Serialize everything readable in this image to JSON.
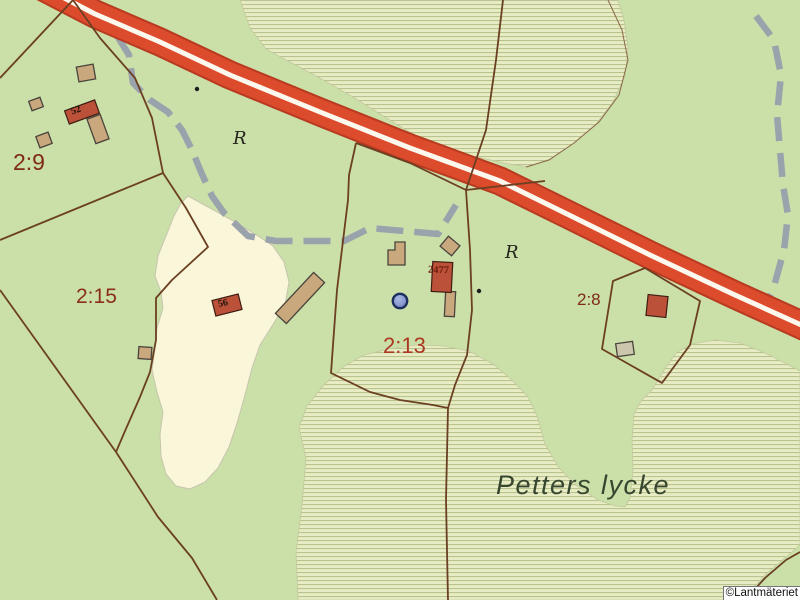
{
  "map": {
    "copyright": "©Lantmäteriet",
    "place_name": "Petters lycke",
    "parcel_labels": [
      {
        "id": "2-9",
        "label": "2:9"
      },
      {
        "id": "2-15",
        "label": "2:15"
      },
      {
        "id": "2-13",
        "label": "2:13"
      },
      {
        "id": "2-8",
        "label": "2:8"
      }
    ],
    "building_labels": [
      {
        "id": "52",
        "label": "52"
      },
      {
        "id": "56",
        "label": "56"
      },
      {
        "id": "2477",
        "label": "2477"
      }
    ],
    "monument_symbols": [
      {
        "glyph": "R"
      },
      {
        "glyph": "R"
      }
    ],
    "colors": {
      "background_green": "#cbdfa9",
      "road_red": "#dd4b2d",
      "road_edge": "#b83a1f",
      "road_stripe": "#fdf8ee",
      "boundary_brown": "#6b3f22",
      "path_gray": "#9aa2ac",
      "field_cream": "#faf6da",
      "hatch_bg": "#e8ecc4",
      "hatch_line": "#b9c38e",
      "building_tan": "#c9a87e",
      "building_red": "#bb5138",
      "well_blue": "#8799cf"
    }
  }
}
